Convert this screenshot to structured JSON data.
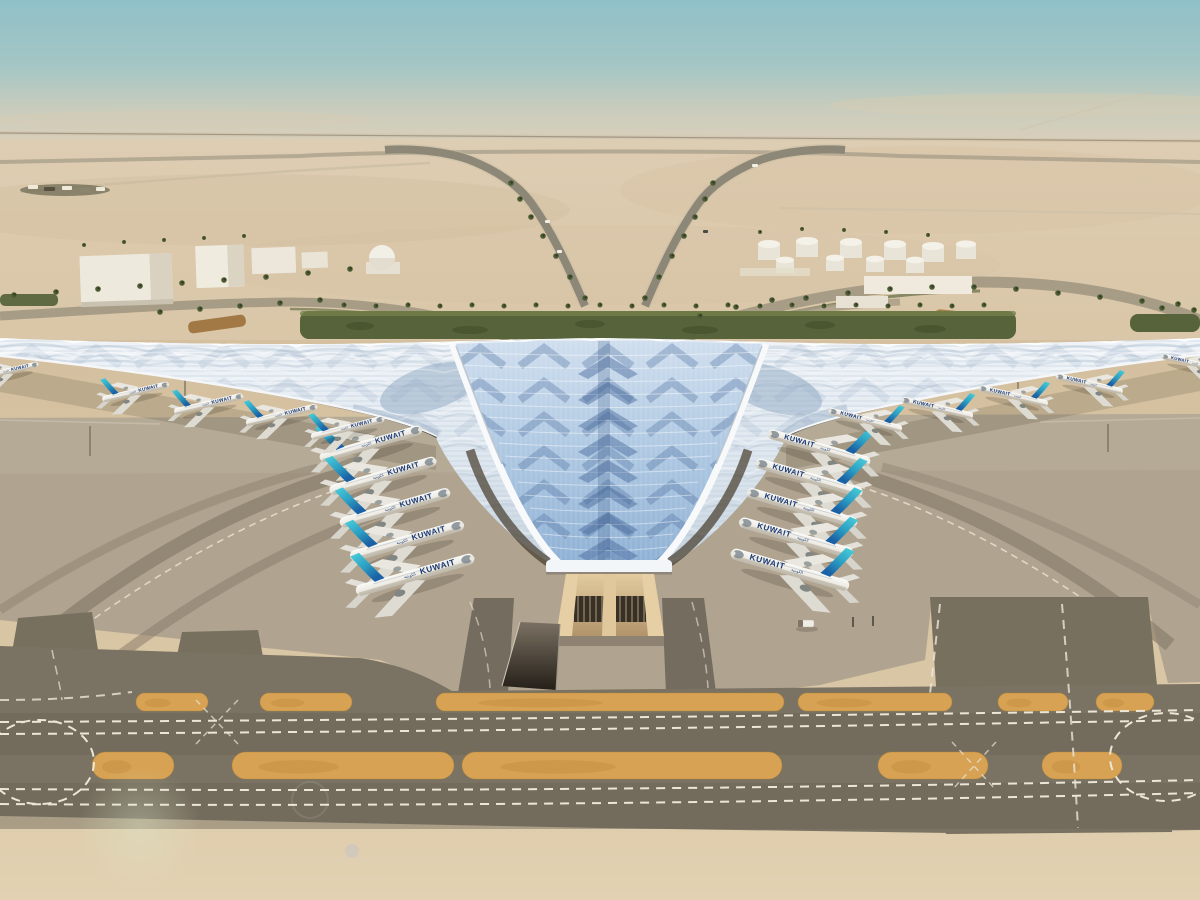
{
  "meta": {
    "description": "Aerial rendering of Kuwait International Airport new terminal: trefoil swooping roof of blue glass and white ribs, Kuwait Airways jets parked around a central glazed valley, desert landside with warehouses, dome building and fuel tanks, palm-lined approach roads, and foreground taxiways with orange median islands."
  },
  "scene": {
    "airline": {
      "title": "KUWAIT",
      "title_ar": "الكويتية"
    },
    "colors": {
      "sky_top": "#8fc0c8",
      "sky_horizon": "#ded0ba",
      "desert": "#dbc9ad",
      "sand_fore": "#d8c4a2",
      "roof_white": "#f3f6f9",
      "roof_glass": "#a7c2de",
      "roof_shadow_blue": "#47699a",
      "tail_teal": "#49cdd8",
      "tail_blue": "#1a62a5",
      "apron": "#b0a390",
      "taxiway": "#78705f",
      "island_orange": "#d7a254",
      "marking_white": "#ece6d8",
      "green_landscape": "#57633a",
      "eave_glow": "#bb9159",
      "portal_tan": "#d8bd92"
    },
    "aircraft": {
      "visible_count": 20,
      "placements": [
        {
          "x": 370,
          "y": 444,
          "r": -16,
          "s": 0.9
        },
        {
          "x": 382,
          "y": 476,
          "r": -16,
          "s": 0.94
        },
        {
          "x": 394,
          "y": 508,
          "r": -16,
          "s": 0.97
        },
        {
          "x": 406,
          "y": 541,
          "r": -16,
          "s": 1.0
        },
        {
          "x": 414,
          "y": 575,
          "r": -16,
          "s": 1.04
        },
        {
          "x": 820,
          "y": 448,
          "r": 16,
          "s": 0.9
        },
        {
          "x": 810,
          "y": 478,
          "r": 16,
          "s": 0.94
        },
        {
          "x": 803,
          "y": 508,
          "r": 16,
          "s": 0.97
        },
        {
          "x": 797,
          "y": 538,
          "r": 16,
          "s": 1.0
        },
        {
          "x": 791,
          "y": 570,
          "r": 16,
          "s": 1.04
        },
        {
          "x": 8,
          "y": 371,
          "r": -13,
          "s": 0.52
        },
        {
          "x": 135,
          "y": 392,
          "r": -13,
          "s": 0.58
        },
        {
          "x": 208,
          "y": 404,
          "r": -13,
          "s": 0.6
        },
        {
          "x": 281,
          "y": 415,
          "r": -13,
          "s": 0.62
        },
        {
          "x": 347,
          "y": 428,
          "r": -14,
          "s": 0.64
        },
        {
          "x": 1192,
          "y": 363,
          "r": 13,
          "s": 0.52
        },
        {
          "x": 1090,
          "y": 384,
          "r": 13,
          "s": 0.58
        },
        {
          "x": 1014,
          "y": 396,
          "r": 13,
          "s": 0.6
        },
        {
          "x": 938,
          "y": 408,
          "r": 13,
          "s": 0.62
        },
        {
          "x": 866,
          "y": 420,
          "r": 14,
          "s": 0.64
        }
      ]
    },
    "palms": {
      "rows": {
        "front": [
          [
            344,
            305
          ],
          [
            376,
            306
          ],
          [
            408,
            305
          ],
          [
            440,
            306
          ],
          [
            472,
            305
          ],
          [
            504,
            306
          ],
          [
            536,
            305
          ],
          [
            568,
            306
          ],
          [
            600,
            305
          ],
          [
            632,
            306
          ],
          [
            664,
            305
          ],
          [
            696,
            306
          ],
          [
            728,
            305
          ],
          [
            760,
            306
          ],
          [
            792,
            305
          ],
          [
            824,
            306
          ],
          [
            856,
            305
          ],
          [
            888,
            306
          ],
          [
            920,
            305
          ],
          [
            952,
            306
          ],
          [
            984,
            305
          ]
        ],
        "approachL": [
          [
            585,
            298
          ],
          [
            570,
            277
          ],
          [
            556,
            256
          ],
          [
            543,
            236
          ],
          [
            531,
            217
          ],
          [
            520,
            199
          ],
          [
            511,
            183
          ]
        ],
        "approachR": [
          [
            645,
            298
          ],
          [
            659,
            277
          ],
          [
            672,
            256
          ],
          [
            684,
            236
          ],
          [
            695,
            217
          ],
          [
            705,
            199
          ],
          [
            713,
            183
          ]
        ],
        "leftDiag1": [
          [
            14,
            295
          ],
          [
            56,
            292
          ],
          [
            98,
            289
          ],
          [
            140,
            286
          ],
          [
            182,
            283
          ],
          [
            224,
            280
          ],
          [
            266,
            277
          ],
          [
            308,
            273
          ],
          [
            350,
            269
          ]
        ],
        "leftDiag2": [
          [
            160,
            312
          ],
          [
            200,
            309
          ],
          [
            240,
            306
          ],
          [
            280,
            303
          ],
          [
            320,
            300
          ]
        ],
        "rightCurve": [
          [
            806,
            298
          ],
          [
            848,
            293
          ],
          [
            890,
            289
          ],
          [
            932,
            287
          ],
          [
            974,
            287
          ],
          [
            1016,
            289
          ],
          [
            1058,
            293
          ],
          [
            1100,
            297
          ],
          [
            1142,
            301
          ]
        ],
        "tanksRow": [
          [
            760,
            232
          ],
          [
            802,
            229
          ],
          [
            844,
            230
          ],
          [
            886,
            232
          ],
          [
            928,
            235
          ]
        ],
        "warehouseRow": [
          [
            84,
            245
          ],
          [
            124,
            242
          ],
          [
            164,
            240
          ],
          [
            204,
            238
          ],
          [
            244,
            236
          ]
        ],
        "rightEdge": [
          [
            1162,
            308
          ],
          [
            1178,
            304
          ],
          [
            1194,
            310
          ]
        ],
        "rampRoad": [
          [
            700,
            316
          ],
          [
            736,
            307
          ],
          [
            772,
            300
          ]
        ]
      }
    },
    "islands": {
      "row1": {
        "y": 693,
        "h": 18,
        "segments": [
          [
            136,
            72
          ],
          [
            260,
            92
          ],
          [
            436,
            348
          ],
          [
            798,
            154
          ],
          [
            998,
            70
          ],
          [
            1096,
            58
          ]
        ]
      },
      "row2": {
        "y": 752,
        "h": 27,
        "segments": [
          [
            92,
            82
          ],
          [
            232,
            222
          ],
          [
            462,
            320
          ],
          [
            878,
            110
          ],
          [
            1042,
            80
          ]
        ]
      }
    }
  }
}
